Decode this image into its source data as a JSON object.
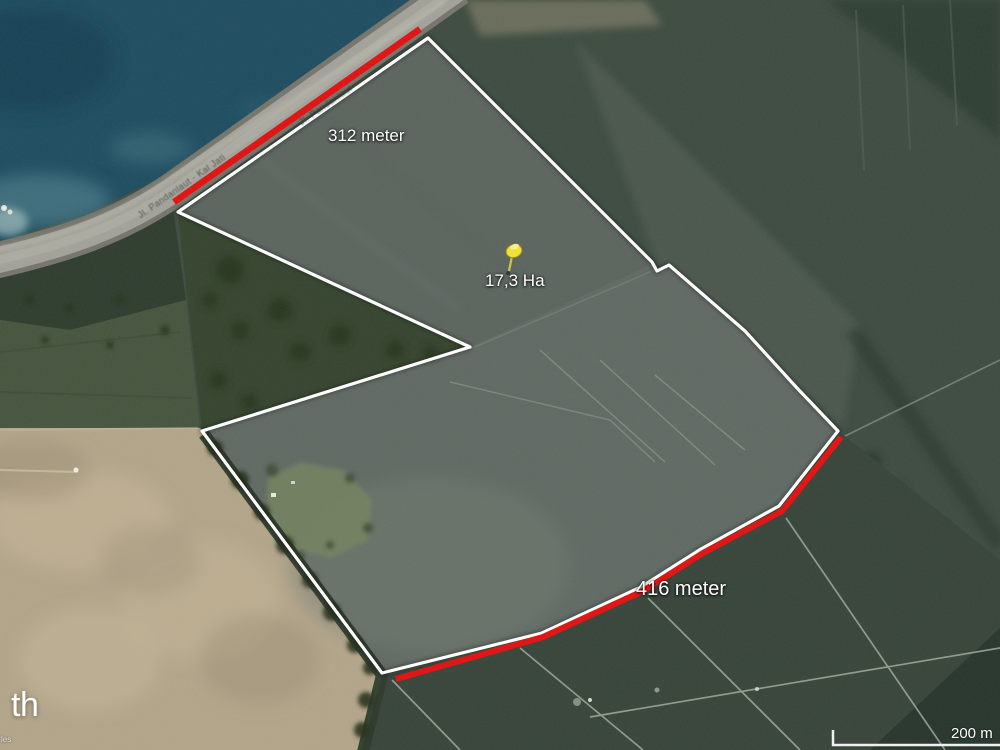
{
  "map": {
    "type": "satellite-imagery",
    "labels": {
      "segment_north": "312 meter",
      "segment_south": "416 meter",
      "area": "17,3 Ha",
      "road_1": "Jl. Pandanlaut - Kal Jati",
      "road_2": "Jl. Pandanlaut"
    },
    "marker": {
      "kind": "pushpin",
      "color": "#f2e23a",
      "label": "17,3 Ha"
    },
    "scale_bar": {
      "label": "200 m"
    },
    "attribution": {
      "logo_fragment": "th",
      "copyright_fragment": "les"
    },
    "colors": {
      "boundary_outline": "#ffffff",
      "measured_segment": "#e11212",
      "water": "#1f4d60",
      "road": "#a2a29a",
      "bare_field": "#b3a58a"
    }
  }
}
